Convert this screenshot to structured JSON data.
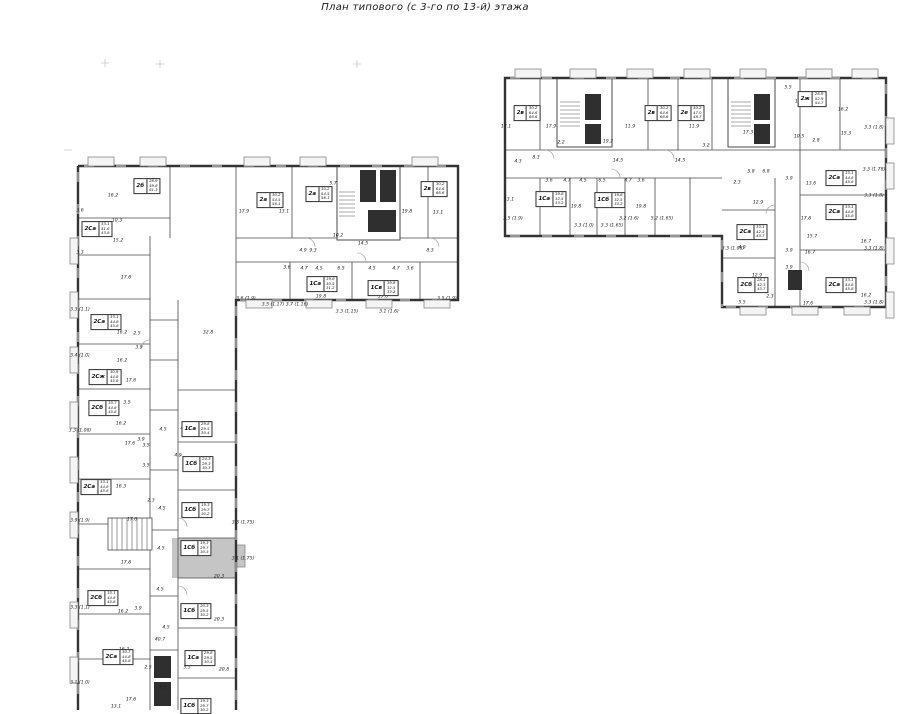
{
  "title": "План типового (с 3-го по 13-й) этажа",
  "colors": {
    "highlight": "#c5c5c5",
    "exterior_wall": "#333333",
    "interior_wall": "#4a4a4a",
    "core_fill": "#2f2f2f"
  },
  "highlighted_unit": {
    "code": "1Сб",
    "note": "shaded apartment in left wing"
  },
  "units": [
    {
      "code": "2б",
      "areas": [
        "26.9",
        "59.8",
        "61.3"
      ],
      "x": 147,
      "y": 186
    },
    {
      "code": "2а",
      "areas": [
        "30.2",
        "54.5",
        "56.1"
      ],
      "x": 270,
      "y": 200
    },
    {
      "code": "2а",
      "areas": [
        "30.2",
        "54.5",
        "56.1"
      ],
      "x": 319,
      "y": 194
    },
    {
      "code": "2в",
      "areas": [
        "30.2",
        "64.6",
        "66.6"
      ],
      "x": 434,
      "y": 189
    },
    {
      "code": "1Са",
      "areas": [
        "19.8",
        "30.5",
        "31.2"
      ],
      "x": 322,
      "y": 284
    },
    {
      "code": "1Св",
      "areas": [
        "19.8",
        "32.5",
        "33.2"
      ],
      "x": 383,
      "y": 288
    },
    {
      "code": "2Са",
      "areas": [
        "33.1",
        "41.6",
        "43.8"
      ],
      "x": 97,
      "y": 229
    },
    {
      "code": "2Са",
      "areas": [
        "33.1",
        "44.8",
        "45.8"
      ],
      "x": 106,
      "y": 322
    },
    {
      "code": "2Сж",
      "areas": [
        "30.9",
        "44.8",
        "45.8"
      ],
      "x": 105,
      "y": 377
    },
    {
      "code": "2Сб",
      "areas": [
        "33.7",
        "44.8",
        "45.8"
      ],
      "x": 104,
      "y": 408
    },
    {
      "code": "2Са",
      "areas": [
        "33.1",
        "44.8",
        "45.8"
      ],
      "x": 96,
      "y": 487
    },
    {
      "code": "2Сб",
      "areas": [
        "33.1",
        "44.8",
        "45.8"
      ],
      "x": 103,
      "y": 598
    },
    {
      "code": "2Са",
      "areas": [
        "30.7",
        "44.8",
        "45.8"
      ],
      "x": 118,
      "y": 657
    },
    {
      "code": "1Са",
      "areas": [
        "29.8",
        "29.5",
        "30.4"
      ],
      "x": 197,
      "y": 429
    },
    {
      "code": "1Сб",
      "areas": [
        "24.3",
        "29.3",
        "30.3"
      ],
      "x": 198,
      "y": 464
    },
    {
      "code": "1Сб",
      "areas": [
        "19.3",
        "29.7",
        "30.2"
      ],
      "x": 197,
      "y": 510
    },
    {
      "code": "1Сб",
      "areas": [
        "19.3",
        "29.7",
        "30.3"
      ],
      "x": 196,
      "y": 548,
      "hl": true
    },
    {
      "code": "1Сб",
      "areas": [
        "20.3",
        "29.5",
        "30.2"
      ],
      "x": 196,
      "y": 611
    },
    {
      "code": "1Са",
      "areas": [
        "29.8",
        "29.5",
        "30.4"
      ],
      "x": 200,
      "y": 658
    },
    {
      "code": "1Сб",
      "areas": [
        "19.3",
        "29.7",
        "30.2"
      ],
      "x": 196,
      "y": 706
    },
    {
      "code": "2в",
      "areas": [
        "30.2",
        "64.6",
        "66.6"
      ],
      "x": 527,
      "y": 113
    },
    {
      "code": "2в",
      "areas": [
        "30.2",
        "64.6",
        "66.6"
      ],
      "x": 658,
      "y": 113
    },
    {
      "code": "2е",
      "areas": [
        "30.2",
        "47.0",
        "48.7"
      ],
      "x": 691,
      "y": 113
    },
    {
      "code": "2ж",
      "areas": [
        "26.9",
        "52.9",
        "54.7"
      ],
      "x": 812,
      "y": 99
    },
    {
      "code": "1Са",
      "areas": [
        "19.8",
        "32.5",
        "33.2"
      ],
      "x": 551,
      "y": 199
    },
    {
      "code": "1Сб",
      "areas": [
        "19.8",
        "32.5",
        "33.2"
      ],
      "x": 610,
      "y": 200
    },
    {
      "code": "2Са",
      "areas": [
        "33.1",
        "44.8",
        "45.8"
      ],
      "x": 841,
      "y": 178
    },
    {
      "code": "2Са",
      "areas": [
        "33.1",
        "44.8",
        "45.8"
      ],
      "x": 841,
      "y": 212
    },
    {
      "code": "2Са",
      "areas": [
        "33.1",
        "42.3",
        "43.7"
      ],
      "x": 752,
      "y": 232
    },
    {
      "code": "2Сб",
      "areas": [
        "28.1",
        "42.3",
        "43.7"
      ],
      "x": 753,
      "y": 285
    },
    {
      "code": "2Са",
      "areas": [
        "33.1",
        "44.8",
        "45.8"
      ],
      "x": 841,
      "y": 285
    }
  ],
  "dims": [
    {
      "t": "16.2",
      "x": 113,
      "y": 196
    },
    {
      "t": "10.3",
      "x": 117,
      "y": 221
    },
    {
      "t": "3.6",
      "x": 80,
      "y": 211
    },
    {
      "t": "17.9",
      "x": 244,
      "y": 212
    },
    {
      "t": "13.1",
      "x": 284,
      "y": 212
    },
    {
      "t": "5.7",
      "x": 333,
      "y": 184
    },
    {
      "t": "19.8",
      "x": 407,
      "y": 212
    },
    {
      "t": "13.1",
      "x": 438,
      "y": 213
    },
    {
      "t": "10.2",
      "x": 338,
      "y": 236
    },
    {
      "t": "14.5",
      "x": 363,
      "y": 244
    },
    {
      "t": "4.9",
      "x": 303,
      "y": 251
    },
    {
      "t": "9.3",
      "x": 313,
      "y": 251
    },
    {
      "t": "8.3",
      "x": 430,
      "y": 251
    },
    {
      "t": "3.6",
      "x": 287,
      "y": 268
    },
    {
      "t": "4.7",
      "x": 304,
      "y": 269
    },
    {
      "t": "4.5",
      "x": 319,
      "y": 269
    },
    {
      "t": "6.5",
      "x": 341,
      "y": 269
    },
    {
      "t": "4.5",
      "x": 372,
      "y": 269
    },
    {
      "t": "4.7",
      "x": 396,
      "y": 269
    },
    {
      "t": "3.6",
      "x": 410,
      "y": 269
    },
    {
      "t": "19.8",
      "x": 321,
      "y": 297
    },
    {
      "t": "19.8",
      "x": 383,
      "y": 297
    },
    {
      "t": "3.6 (1.9)",
      "x": 246,
      "y": 299
    },
    {
      "t": "3.5 (1.17)",
      "x": 273,
      "y": 305
    },
    {
      "t": "3.7 (1.16)",
      "x": 297,
      "y": 305
    },
    {
      "t": "3.3 (1.15)",
      "x": 347,
      "y": 312
    },
    {
      "t": "3.1 (1.6)",
      "x": 389,
      "y": 312
    },
    {
      "t": "3.5 (1.9)",
      "x": 447,
      "y": 299
    },
    {
      "t": "15.2",
      "x": 118,
      "y": 241
    },
    {
      "t": "3.3",
      "x": 80,
      "y": 253
    },
    {
      "t": "17.6",
      "x": 126,
      "y": 278
    },
    {
      "t": "32.8",
      "x": 208,
      "y": 333
    },
    {
      "t": "16.2",
      "x": 122,
      "y": 333
    },
    {
      "t": "2.5",
      "x": 137,
      "y": 334
    },
    {
      "t": "3.9",
      "x": 139,
      "y": 348
    },
    {
      "t": "16.2",
      "x": 122,
      "y": 361
    },
    {
      "t": "17.6",
      "x": 131,
      "y": 381
    },
    {
      "t": "3.5",
      "x": 127,
      "y": 403
    },
    {
      "t": "16.2",
      "x": 121,
      "y": 424
    },
    {
      "t": "17.6",
      "x": 130,
      "y": 444
    },
    {
      "t": "3.9",
      "x": 141,
      "y": 440
    },
    {
      "t": "16.3",
      "x": 121,
      "y": 487
    },
    {
      "t": "17.6",
      "x": 132,
      "y": 520
    },
    {
      "t": "17.6",
      "x": 126,
      "y": 563
    },
    {
      "t": "16.2",
      "x": 123,
      "y": 612
    },
    {
      "t": "3.9",
      "x": 138,
      "y": 609
    },
    {
      "t": "16.2",
      "x": 124,
      "y": 650
    },
    {
      "t": "17.6",
      "x": 131,
      "y": 700
    },
    {
      "t": "13.1",
      "x": 116,
      "y": 707
    },
    {
      "t": "3.3 (1.1)",
      "x": 80,
      "y": 310
    },
    {
      "t": "3.4 (1.0)",
      "x": 80,
      "y": 356
    },
    {
      "t": "3.3 (1.08)",
      "x": 80,
      "y": 431
    },
    {
      "t": "3.9 (1.9)",
      "x": 80,
      "y": 521
    },
    {
      "t": "3.3 (1.1)",
      "x": 80,
      "y": 608
    },
    {
      "t": "3.1 (1.0)",
      "x": 80,
      "y": 683
    },
    {
      "t": "4.5",
      "x": 163,
      "y": 430
    },
    {
      "t": "4.9",
      "x": 184,
      "y": 429
    },
    {
      "t": "3.5",
      "x": 146,
      "y": 446
    },
    {
      "t": "3.5",
      "x": 146,
      "y": 466
    },
    {
      "t": "4.9",
      "x": 178,
      "y": 456
    },
    {
      "t": "2.3",
      "x": 151,
      "y": 501
    },
    {
      "t": "4.5",
      "x": 162,
      "y": 509
    },
    {
      "t": "4.5",
      "x": 161,
      "y": 549
    },
    {
      "t": "4.5",
      "x": 160,
      "y": 590
    },
    {
      "t": "20.3",
      "x": 219,
      "y": 577
    },
    {
      "t": "3.3 (1.75)",
      "x": 243,
      "y": 523
    },
    {
      "t": "3.1 (1.75)",
      "x": 243,
      "y": 559
    },
    {
      "t": "40.7",
      "x": 160,
      "y": 640
    },
    {
      "t": "2.5",
      "x": 148,
      "y": 668
    },
    {
      "t": "5.5",
      "x": 187,
      "y": 668
    },
    {
      "t": "20.8",
      "x": 224,
      "y": 670
    },
    {
      "t": "4.5",
      "x": 163,
      "y": 688
    },
    {
      "t": "20.3",
      "x": 219,
      "y": 620
    },
    {
      "t": "4.5",
      "x": 166,
      "y": 628
    },
    {
      "t": "17.1",
      "x": 506,
      "y": 127
    },
    {
      "t": "17.9",
      "x": 551,
      "y": 127
    },
    {
      "t": "11.9",
      "x": 630,
      "y": 127
    },
    {
      "t": "2.2",
      "x": 561,
      "y": 143
    },
    {
      "t": "19.2",
      "x": 608,
      "y": 142
    },
    {
      "t": "14.5",
      "x": 618,
      "y": 161
    },
    {
      "t": "4.3",
      "x": 518,
      "y": 162
    },
    {
      "t": "8.3",
      "x": 536,
      "y": 158
    },
    {
      "t": "3.6",
      "x": 549,
      "y": 181
    },
    {
      "t": "4.7",
      "x": 567,
      "y": 181
    },
    {
      "t": "4.5",
      "x": 583,
      "y": 181
    },
    {
      "t": "6.5",
      "x": 602,
      "y": 181
    },
    {
      "t": "4.7",
      "x": 628,
      "y": 181
    },
    {
      "t": "3.6",
      "x": 641,
      "y": 181
    },
    {
      "t": "13.1",
      "x": 509,
      "y": 200
    },
    {
      "t": "19.8",
      "x": 576,
      "y": 207
    },
    {
      "t": "19.8",
      "x": 641,
      "y": 207
    },
    {
      "t": "3.5 (1.9)",
      "x": 513,
      "y": 219
    },
    {
      "t": "3.2 (1.6)",
      "x": 629,
      "y": 219
    },
    {
      "t": "5.2 (1.65)",
      "x": 662,
      "y": 219
    },
    {
      "t": "3.3 (1.0)",
      "x": 584,
      "y": 226
    },
    {
      "t": "3.3 (1.65)",
      "x": 612,
      "y": 226
    },
    {
      "t": "11.9",
      "x": 694,
      "y": 127
    },
    {
      "t": "3.2",
      "x": 706,
      "y": 146
    },
    {
      "t": "17.3",
      "x": 748,
      "y": 133
    },
    {
      "t": "10.5",
      "x": 799,
      "y": 137
    },
    {
      "t": "2.8",
      "x": 816,
      "y": 141
    },
    {
      "t": "5.5",
      "x": 788,
      "y": 88
    },
    {
      "t": "17.1",
      "x": 800,
      "y": 102
    },
    {
      "t": "16.2",
      "x": 843,
      "y": 110
    },
    {
      "t": "15.3",
      "x": 846,
      "y": 134
    },
    {
      "t": "2.3",
      "x": 737,
      "y": 183
    },
    {
      "t": "5.8",
      "x": 751,
      "y": 172
    },
    {
      "t": "6.8",
      "x": 766,
      "y": 172
    },
    {
      "t": "12.9",
      "x": 758,
      "y": 203
    },
    {
      "t": "3.9",
      "x": 789,
      "y": 179
    },
    {
      "t": "13.6",
      "x": 811,
      "y": 184
    },
    {
      "t": "17.6",
      "x": 806,
      "y": 219
    },
    {
      "t": "15.7",
      "x": 812,
      "y": 237
    },
    {
      "t": "4.9",
      "x": 742,
      "y": 248
    },
    {
      "t": "3.9",
      "x": 789,
      "y": 251
    },
    {
      "t": "3.9",
      "x": 789,
      "y": 268
    },
    {
      "t": "16.7",
      "x": 810,
      "y": 253
    },
    {
      "t": "12.9",
      "x": 757,
      "y": 276
    },
    {
      "t": "4.5",
      "x": 760,
      "y": 283
    },
    {
      "t": "2.3",
      "x": 770,
      "y": 297
    },
    {
      "t": "5.5",
      "x": 742,
      "y": 303
    },
    {
      "t": "17.6",
      "x": 808,
      "y": 304
    },
    {
      "t": "16.7",
      "x": 866,
      "y": 242
    },
    {
      "t": "16.2",
      "x": 866,
      "y": 296
    },
    {
      "t": "3.3 (1.8)",
      "x": 874,
      "y": 128
    },
    {
      "t": "3.3 (1.78)",
      "x": 874,
      "y": 170
    },
    {
      "t": "3.3 (1.8)",
      "x": 874,
      "y": 196
    },
    {
      "t": "3.3 (1.8)",
      "x": 874,
      "y": 249
    },
    {
      "t": "3.3 (1.8)",
      "x": 874,
      "y": 303
    },
    {
      "t": "3.3 (1.08)",
      "x": 733,
      "y": 249
    },
    {
      "t": "14.5",
      "x": 680,
      "y": 161
    }
  ]
}
